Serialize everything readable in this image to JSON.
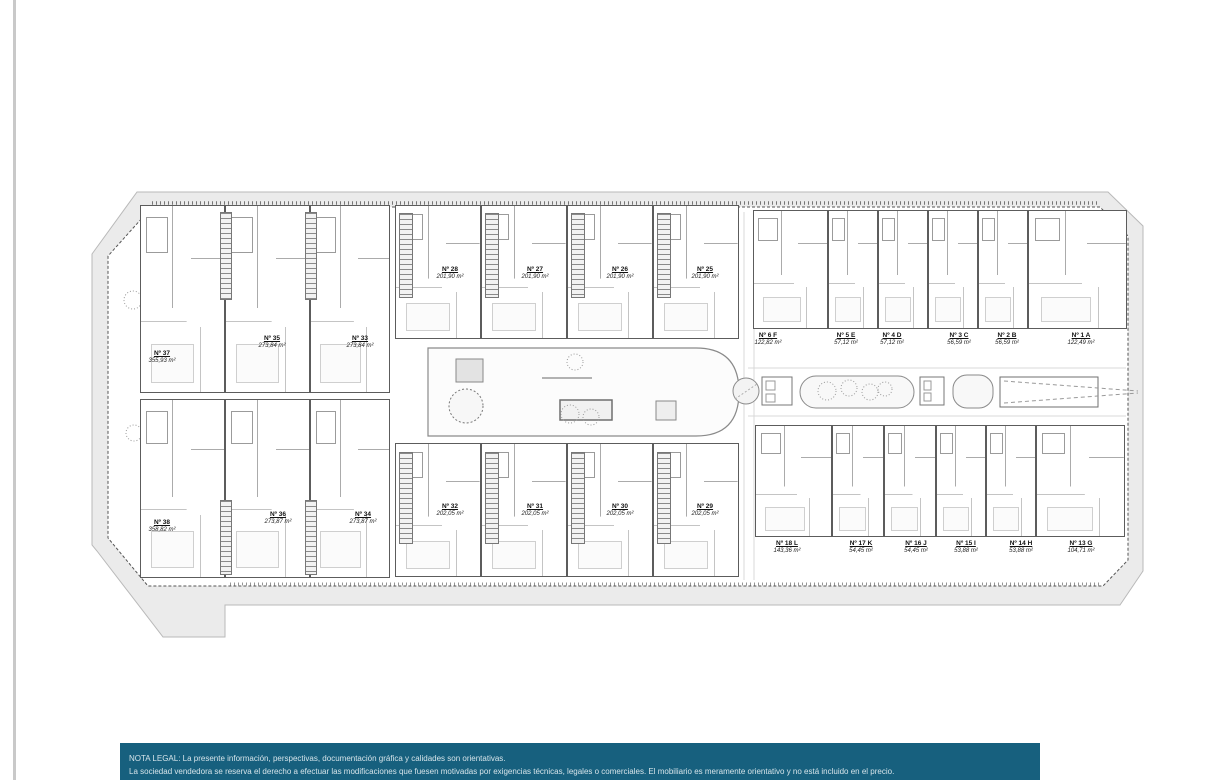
{
  "plan": {
    "units": [
      {
        "number": "Nº 37",
        "area": "355,93 m²"
      },
      {
        "number": "Nº 35",
        "area": "273,84 m²"
      },
      {
        "number": "Nº 33",
        "area": "273,84 m²"
      },
      {
        "number": "Nº 38",
        "area": "358,82 m²"
      },
      {
        "number": "Nº 36",
        "area": "273,87 m²"
      },
      {
        "number": "Nº 34",
        "area": "273,87 m²"
      },
      {
        "number": "Nº 28",
        "area": "201,90 m²"
      },
      {
        "number": "Nº 27",
        "area": "201,90 m²"
      },
      {
        "number": "Nº 26",
        "area": "201,90 m²"
      },
      {
        "number": "Nº 25",
        "area": "201,90 m²"
      },
      {
        "number": "Nº 32",
        "area": "202,05 m²"
      },
      {
        "number": "Nº 31",
        "area": "202,05 m²"
      },
      {
        "number": "Nº 30",
        "area": "202,05 m²"
      },
      {
        "number": "Nº 29",
        "area": "202,05 m²"
      },
      {
        "number": "Nº 6 F",
        "area": "122,82 m²"
      },
      {
        "number": "Nº 5 E",
        "area": "57,12 m²"
      },
      {
        "number": "Nº 4 D",
        "area": "57,12 m²"
      },
      {
        "number": "Nº 3 C",
        "area": "56,59 m²"
      },
      {
        "number": "Nº 2 B",
        "area": "56,59 m²"
      },
      {
        "number": "Nº 1 A",
        "area": "122,49 m²"
      },
      {
        "number": "Nº 18 L",
        "area": "143,36 m²"
      },
      {
        "number": "Nº 17 K",
        "area": "54,45 m²"
      },
      {
        "number": "Nº 16 J",
        "area": "54,45 m²"
      },
      {
        "number": "Nº 15 I",
        "area": "53,88 m²"
      },
      {
        "number": "Nº 14 H",
        "area": "53,88 m²"
      },
      {
        "number": "Nº 13 G",
        "area": "104,71 m²"
      }
    ]
  },
  "legal": {
    "title": "NOTA LEGAL:",
    "line1": "La presente información, perspectivas, documentación gráfica y calidades son orientativas.",
    "line2": "La sociedad vendedora se reserva el derecho a efectuar las modificaciones que fuesen motivadas por exigencias técnicas, legales o comerciales. El mobiliario es meramente orientativo y no está incluido en el precio."
  },
  "colors": {
    "legal_band_bg": "#17607E",
    "legal_text": "#D6E4EA",
    "site_band": "#EBEBEB",
    "line": "#5A5A5A"
  }
}
